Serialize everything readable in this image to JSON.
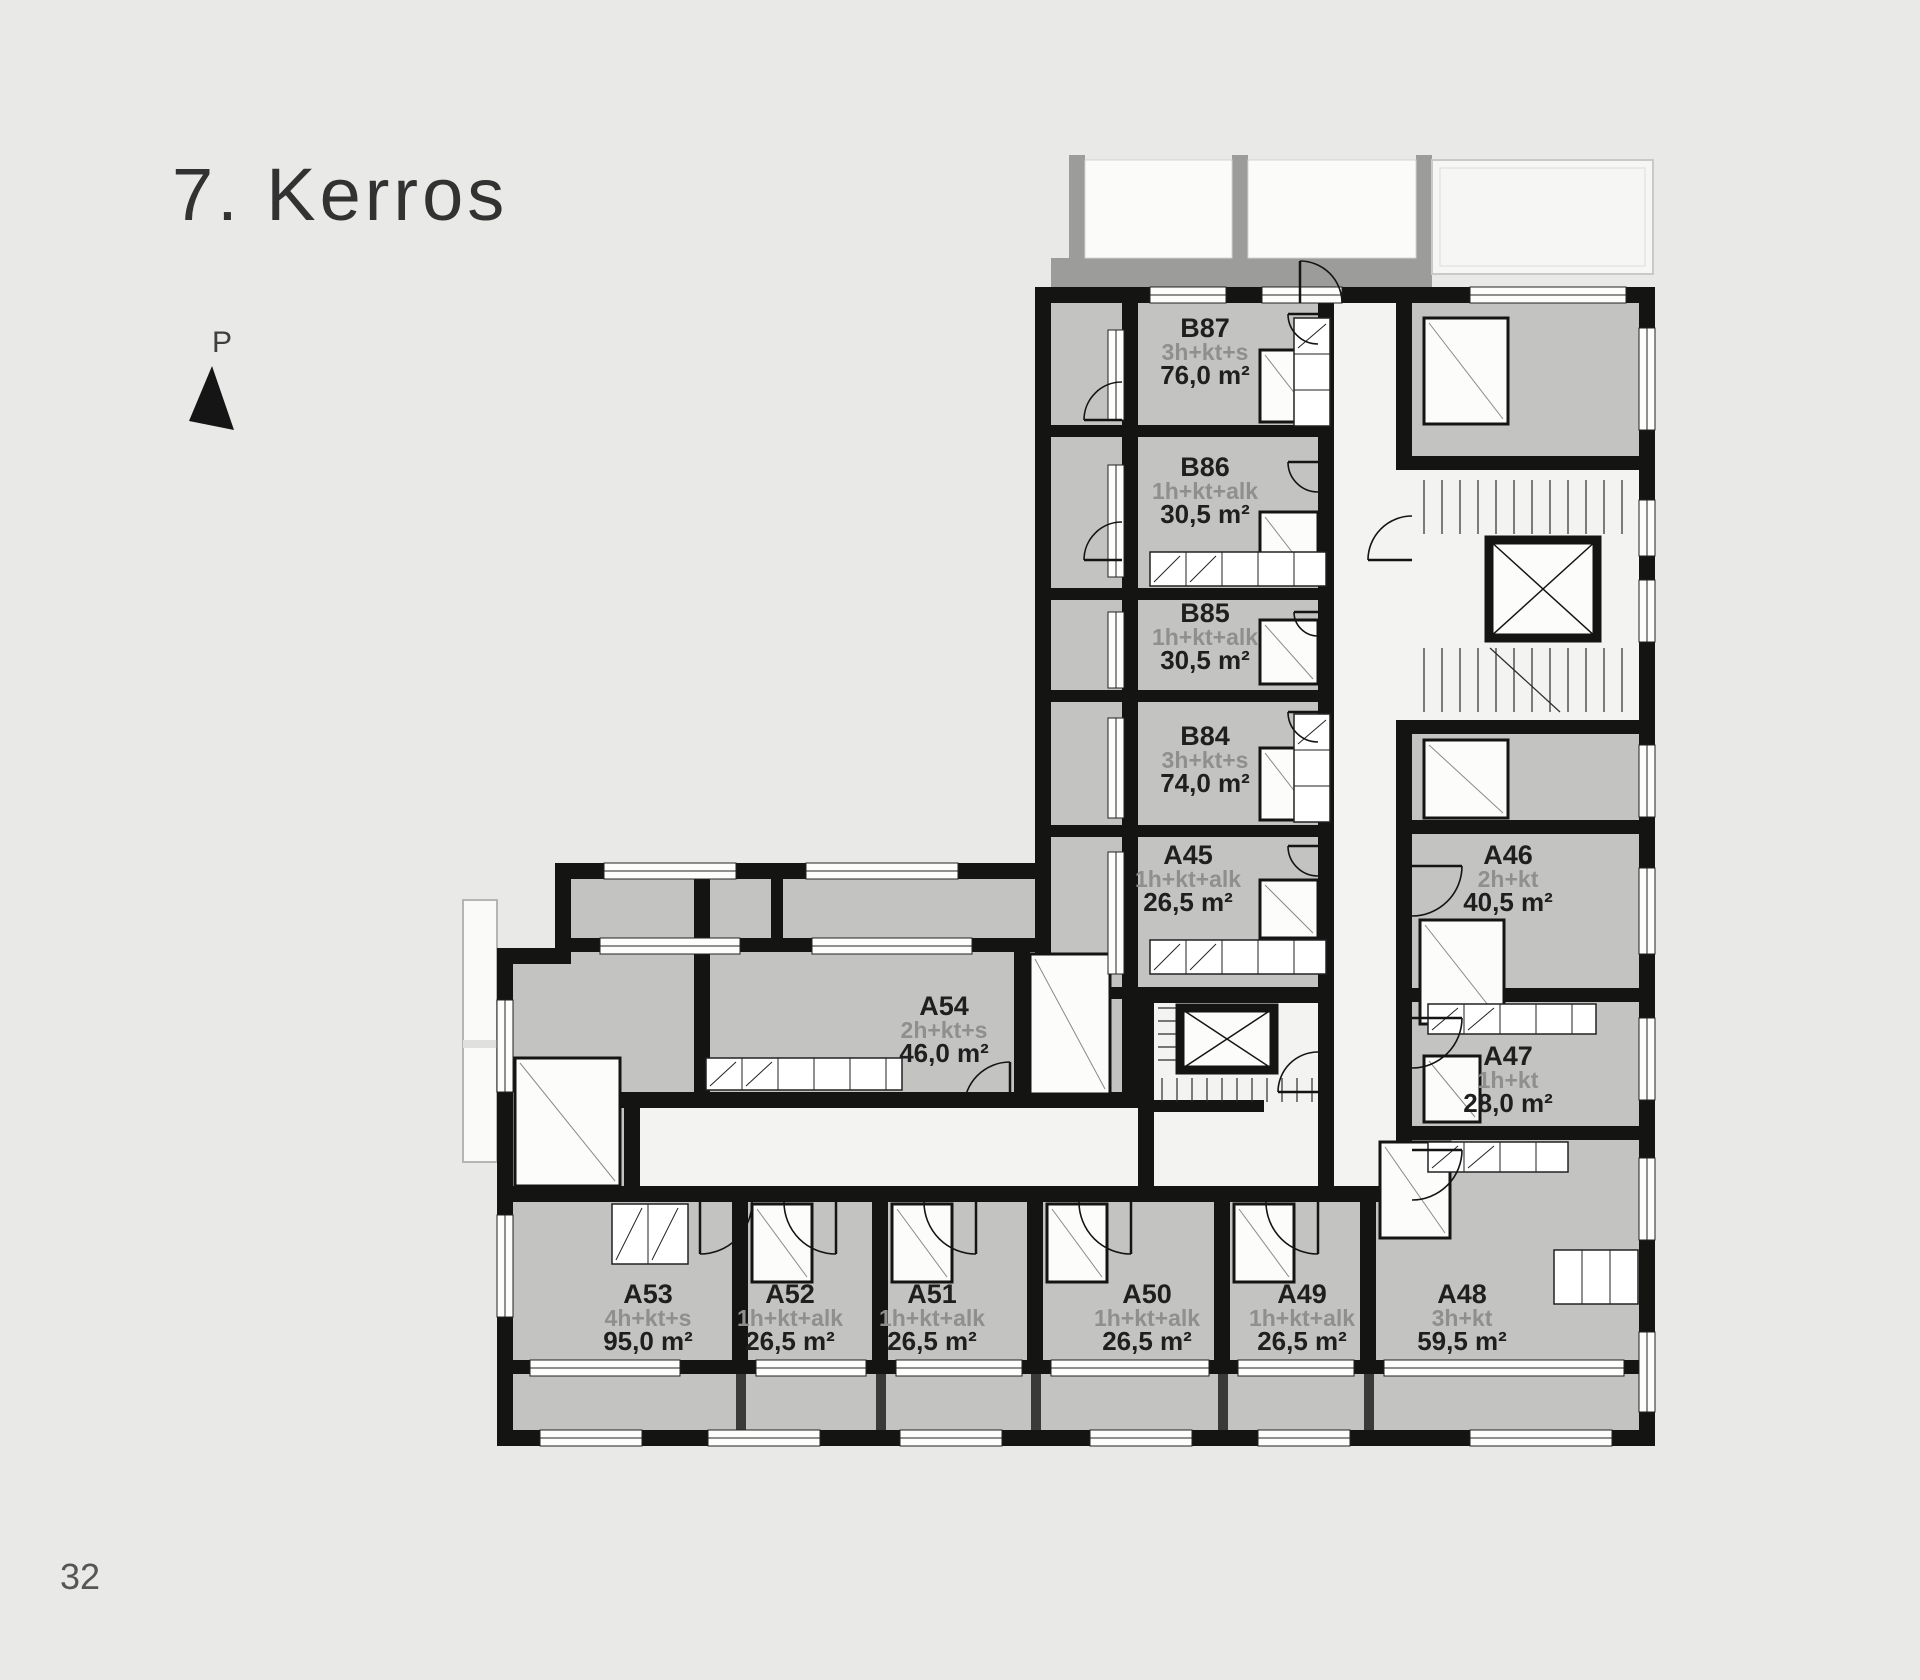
{
  "page": {
    "title": "7. Kerros",
    "page_number": "32",
    "north_label": "P"
  },
  "apartments": [
    {
      "id": "B87",
      "type": "3h+kt+s",
      "area": "76,0 m²"
    },
    {
      "id": "B86",
      "type": "1h+kt+alk",
      "area": "30,5 m²"
    },
    {
      "id": "B85",
      "type": "1h+kt+alk",
      "area": "30,5 m²"
    },
    {
      "id": "B84",
      "type": "3h+kt+s",
      "area": "74,0 m²"
    },
    {
      "id": "A45",
      "type": "1h+kt+alk",
      "area": "26,5 m²"
    },
    {
      "id": "A46",
      "type": "2h+kt",
      "area": "40,5 m²"
    },
    {
      "id": "A47",
      "type": "1h+kt",
      "area": "28,0 m²"
    },
    {
      "id": "A54",
      "type": "2h+kt+s",
      "area": "46,0 m²"
    },
    {
      "id": "A53",
      "type": "4h+kt+s",
      "area": "95,0 m²"
    },
    {
      "id": "A52",
      "type": "1h+kt+alk",
      "area": "26,5 m²"
    },
    {
      "id": "A51",
      "type": "1h+kt+alk",
      "area": "26,5 m²"
    },
    {
      "id": "A50",
      "type": "1h+kt+alk",
      "area": "26,5 m²"
    },
    {
      "id": "A49",
      "type": "1h+kt+alk",
      "area": "26,5 m²"
    },
    {
      "id": "A48",
      "type": "3h+kt",
      "area": "59,5 m²"
    }
  ],
  "colors": {
    "background": "#e9e9e8",
    "room_fill": "#c3c3c1",
    "wall": "#141413",
    "corridor": "#f3f3f1",
    "label_gray": "#8f8f8e",
    "label_ink": "#1f1f1f"
  }
}
